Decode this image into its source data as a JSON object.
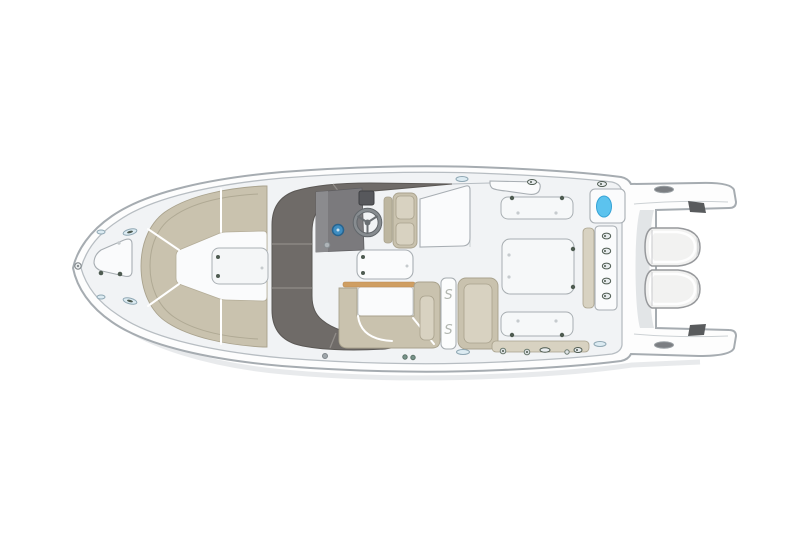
{
  "diagram": {
    "type": "boat-deck-plan-top-view",
    "latch_glyph": "S",
    "engine_count": 2,
    "aft_hatch_count": 3,
    "transom_latch_count": 5
  },
  "palette": {
    "background": "#ffffff",
    "hull_fill": "#fdfdfd",
    "hull_line": "#a6acb1",
    "liner_line": "#b7bdc2",
    "deck_fill": "#f1f3f5",
    "panel_fill": "#fafbfc",
    "panel_line": "#a8aeb3",
    "seat_tan": "#c9c2ae",
    "seat_tan_light": "#d8d2c1",
    "seat_tan_dark": "#bdb6a0",
    "seat_line": "#a9a28d",
    "hardtop_gray": "#6f6b68",
    "hardtop_seam": "#908c88",
    "console_gray": "#7b7a7d",
    "console_dark": "#56575b",
    "wheel_gray": "#6a6f73",
    "gauge_blue": "#3f8ec2",
    "livewell_blue": "#5cc3ee",
    "wood_trim": "#cf9e62",
    "fitting_dark": "#4e5b51",
    "fitting_light": "#e8ecee",
    "metal_light": "#dcebf2",
    "metal_line": "#8fa7b3",
    "engine_fill": "#f2f2f1",
    "engine_line": "#97999c",
    "glyph_gray": "#b2b7b1",
    "shadow_line": "#e0e3e5"
  }
}
